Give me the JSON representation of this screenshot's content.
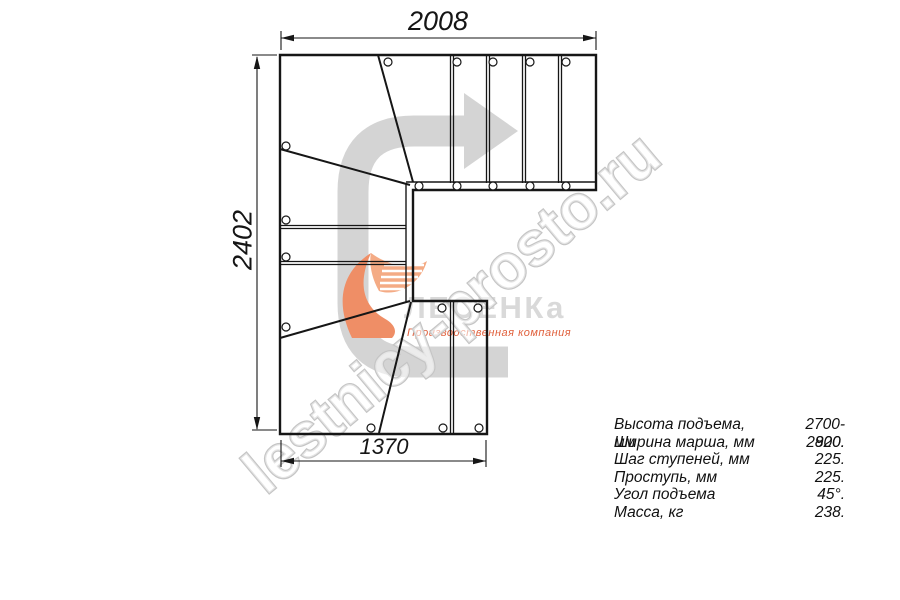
{
  "dimensions": {
    "top": "2008",
    "left": "2402",
    "bottom": "1370"
  },
  "specs": {
    "rows": [
      {
        "label": "Высота подъема, мм",
        "value": "2700-2820."
      },
      {
        "label": "Ширина марша, мм",
        "value": "900."
      },
      {
        "label": "Шаг ступеней, мм",
        "value": "225."
      },
      {
        "label": "Проступь, мм",
        "value": "225."
      },
      {
        "label": "Угол подъема",
        "value": "45°."
      },
      {
        "label": "Масса, кг",
        "value": "238."
      }
    ]
  },
  "logo": {
    "name": "ЛЕСЕНКа",
    "tagline": "Производственная компания"
  },
  "watermark": {
    "text": "lestnicy-prosto.ru"
  },
  "colors": {
    "line": "#161616",
    "arrow_gray": "#d4d4d4",
    "logo_gray": "#d9d9d9",
    "flame_orange": "#ef8e66",
    "flame_light": "#f4ab85",
    "tagline_orange": "#e0603c",
    "watermark_outline": "#c5c5c5"
  }
}
